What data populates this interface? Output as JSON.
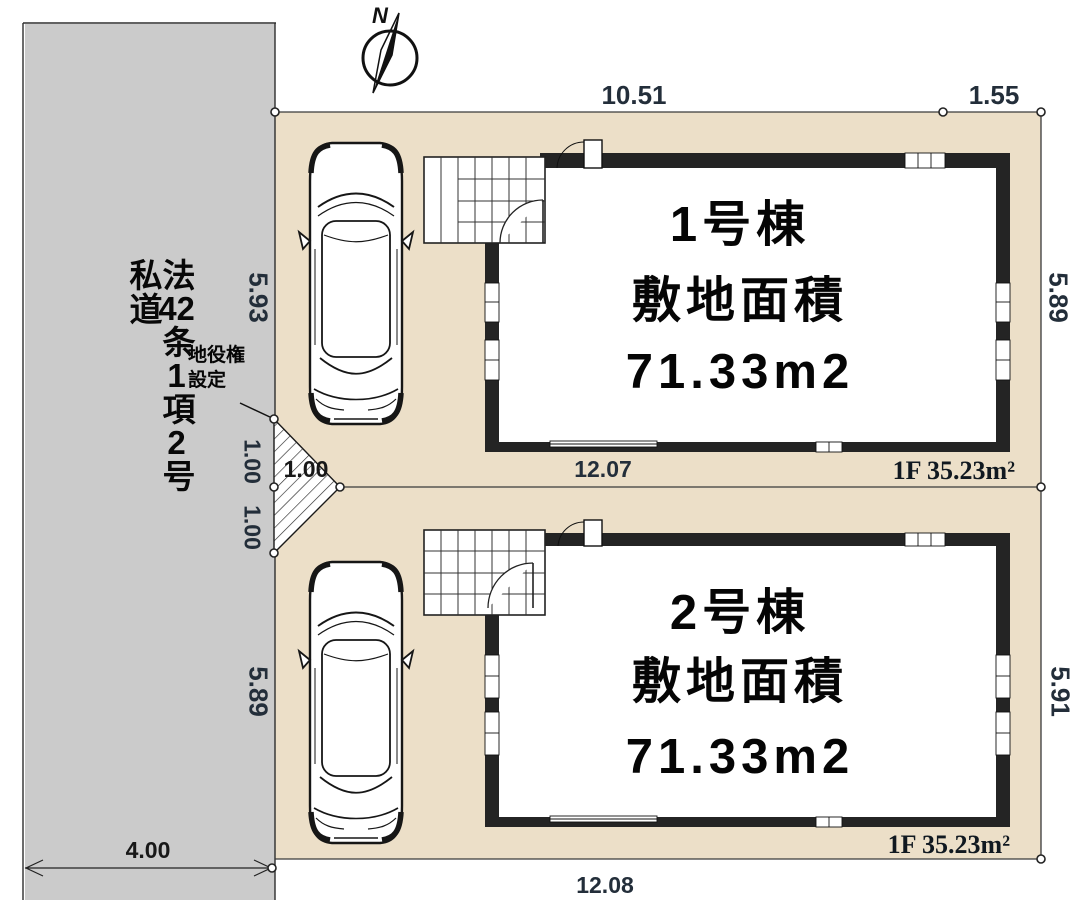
{
  "compass": {
    "north_label": "N"
  },
  "road": {
    "label": "法42条1項2号 私道",
    "label_head": "法",
    "label_num1": "42",
    "label_mid1": "条",
    "label_num2": "1",
    "label_mid2": "項",
    "label_num3": "2",
    "label_mid3": "号",
    "label_tail": "私道",
    "width_dim": "4.00"
  },
  "site": {
    "top_dim_main": "10.51",
    "top_dim_offset": "1.55",
    "bottom_dim": "12.08"
  },
  "easement": {
    "label": "地役権設定\n",
    "label_text": "地役権\n設定",
    "width_dim": "1.00",
    "side_dims": [
      "1.00",
      "1.00"
    ]
  },
  "lot1": {
    "name": "1号棟",
    "area_caption": "敷地面積",
    "area_value": "71.33m2",
    "floor_label": "1F 35.23m²",
    "bottom_dim": "12.07",
    "west_dim": "5.93",
    "east_dim": "5.89"
  },
  "lot2": {
    "name": "2号棟",
    "area_caption": "敷地面積",
    "area_value": "71.33m2",
    "floor_label": "1F 35.23m²",
    "west_dim": "5.89",
    "east_dim": "5.91"
  },
  "colors": {
    "lot_fill": "#ecdfc8",
    "road_fill": "#cbcbcb",
    "wall": "#242424",
    "dim_text": "#232e3a"
  }
}
